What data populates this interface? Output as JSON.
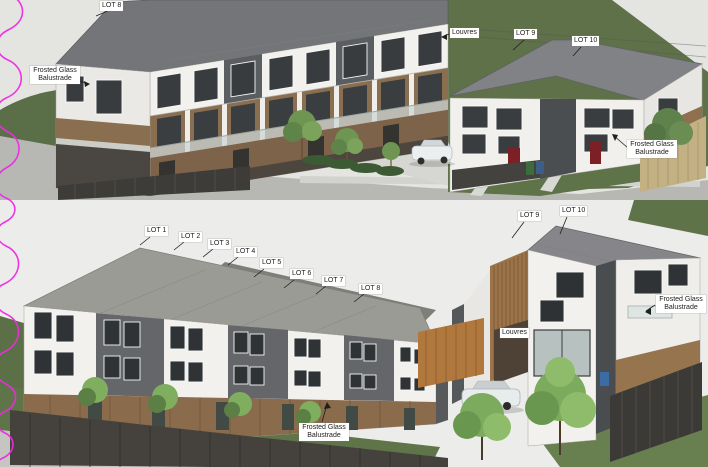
{
  "annotations": {
    "top": [
      {
        "id": "lot-8",
        "text": "LOT 8"
      },
      {
        "id": "frosted-glass-balustrade-left",
        "text": "Frosted Glass Balustrade"
      },
      {
        "id": "louvres",
        "text": "Louvres"
      },
      {
        "id": "lot-9",
        "text": "LOT 9"
      },
      {
        "id": "lot-10",
        "text": "LOT 10"
      },
      {
        "id": "frosted-glass-balustrade-right",
        "text": "Frosted Glass Balustrade"
      }
    ],
    "bottom": [
      {
        "id": "lot-1",
        "text": "LOT 1"
      },
      {
        "id": "lot-2",
        "text": "LOT 2"
      },
      {
        "id": "lot-3",
        "text": "LOT 3"
      },
      {
        "id": "lot-4",
        "text": "LOT 4"
      },
      {
        "id": "lot-5",
        "text": "LOT 5"
      },
      {
        "id": "lot-6",
        "text": "LOT 6"
      },
      {
        "id": "lot-7",
        "text": "LOT 7"
      },
      {
        "id": "lot-8",
        "text": "LOT 8"
      },
      {
        "id": "lot-9",
        "text": "LOT 9"
      },
      {
        "id": "lot-10",
        "text": "LOT 10"
      },
      {
        "id": "frosted-glass-balustrade-right",
        "text": "Frosted Glass Balustrade"
      },
      {
        "id": "louvres",
        "text": "Louvres"
      },
      {
        "id": "frosted-glass-balustrade-front",
        "text": "Frosted Glass Balustrade"
      }
    ]
  },
  "colors": {
    "revision_cloud": "#ee2ae2",
    "hill_green": "#5e7149",
    "grass_green": "#5f7449",
    "roof_gray": "#8b8d8f",
    "cladding_white": "#f2f1ee",
    "cladding_dark": "#5b5e60",
    "timber_cedar": "#8a6e50",
    "fence_dark": "#45423d",
    "fence_timber": "#c3b184",
    "door_red": "#7c2026",
    "label_bg": "#ffffff",
    "label_text": "#1c1c1c"
  }
}
